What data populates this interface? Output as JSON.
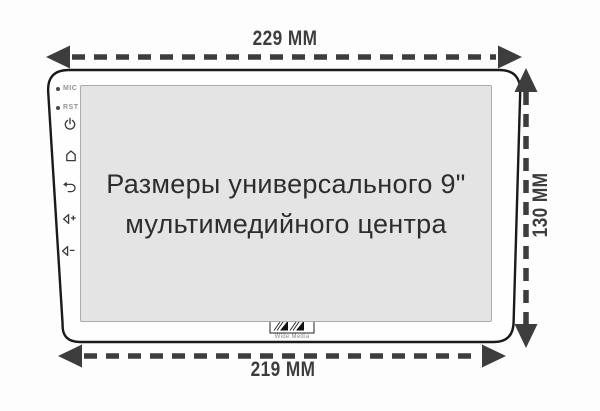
{
  "dimensions": {
    "top_width": "229 MM",
    "bottom_width": "219 MM",
    "height": "130 MM"
  },
  "screen_text": {
    "line1": "Размеры универсального 9\"",
    "line2": "мультимедийного центра"
  },
  "side_controls": {
    "mic_label": "MIC",
    "rst_label": "RST",
    "icons": [
      "power-icon",
      "home-icon",
      "back-icon",
      "volume-up-icon",
      "volume-down-icon"
    ]
  },
  "logo": {
    "brand": "Wide Media"
  },
  "colors": {
    "dimension": "#3d3d3d",
    "outline": "#1a1a1a",
    "screen_bg": "#e4e4e4",
    "caption": "#2d2d2d"
  }
}
